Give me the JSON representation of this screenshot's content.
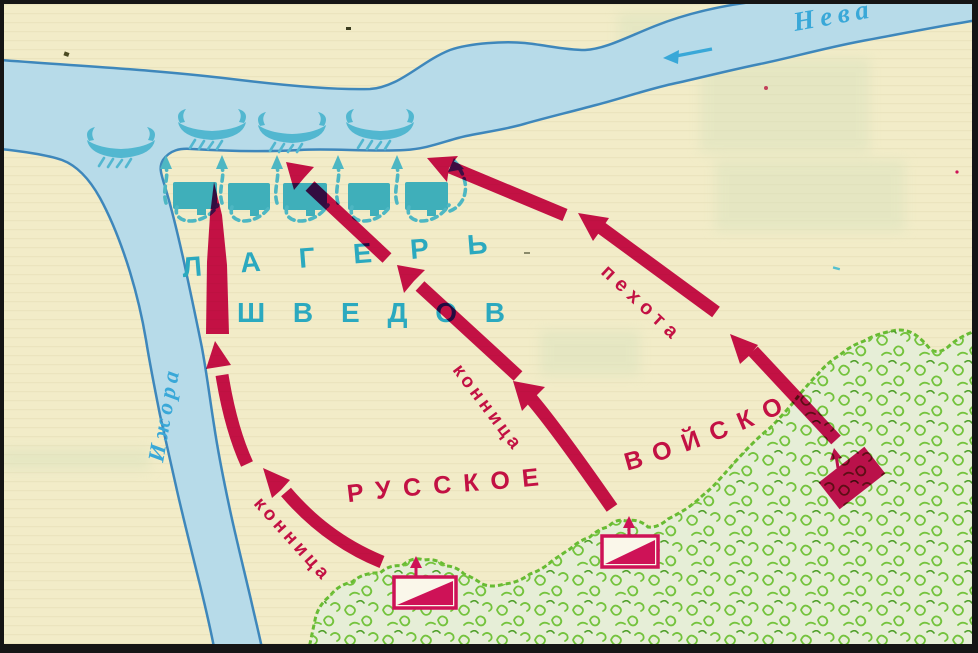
{
  "rivers": {
    "neva": "Нева",
    "izhora": "Ижора",
    "flow_icon": "river-flow-arrow-icon"
  },
  "camp": {
    "label_line1": "ЛАГЕРЬ",
    "label_line2": "ШВЕДОВ",
    "tent_count": 5,
    "ship_count": 4,
    "ship_icon": "viking-longship-icon",
    "flee_arrow_icon": "dashed-flight-arrow-icon"
  },
  "forces": {
    "army_word1": "РУССКОЕ",
    "army_word2": "ВОЙСКО",
    "cavalry_left": "конница",
    "cavalry_middle": "конница",
    "infantry": "пехота",
    "unit_marker_icon": "army-unit-marker-icon"
  },
  "colors": {
    "land": "#f2ecc8",
    "water": "#b7dbe9",
    "water_outline": "#3e87bb",
    "river_text": "#39a8d8",
    "teal": "#3fafba",
    "teal_dash": "#4db7c3",
    "teal_text": "#2ba9bf",
    "ship": "#52b7d0",
    "crimson": "#ce1257",
    "forest_fill": "#e6eed7",
    "forest_stroke": "#68bb33"
  }
}
